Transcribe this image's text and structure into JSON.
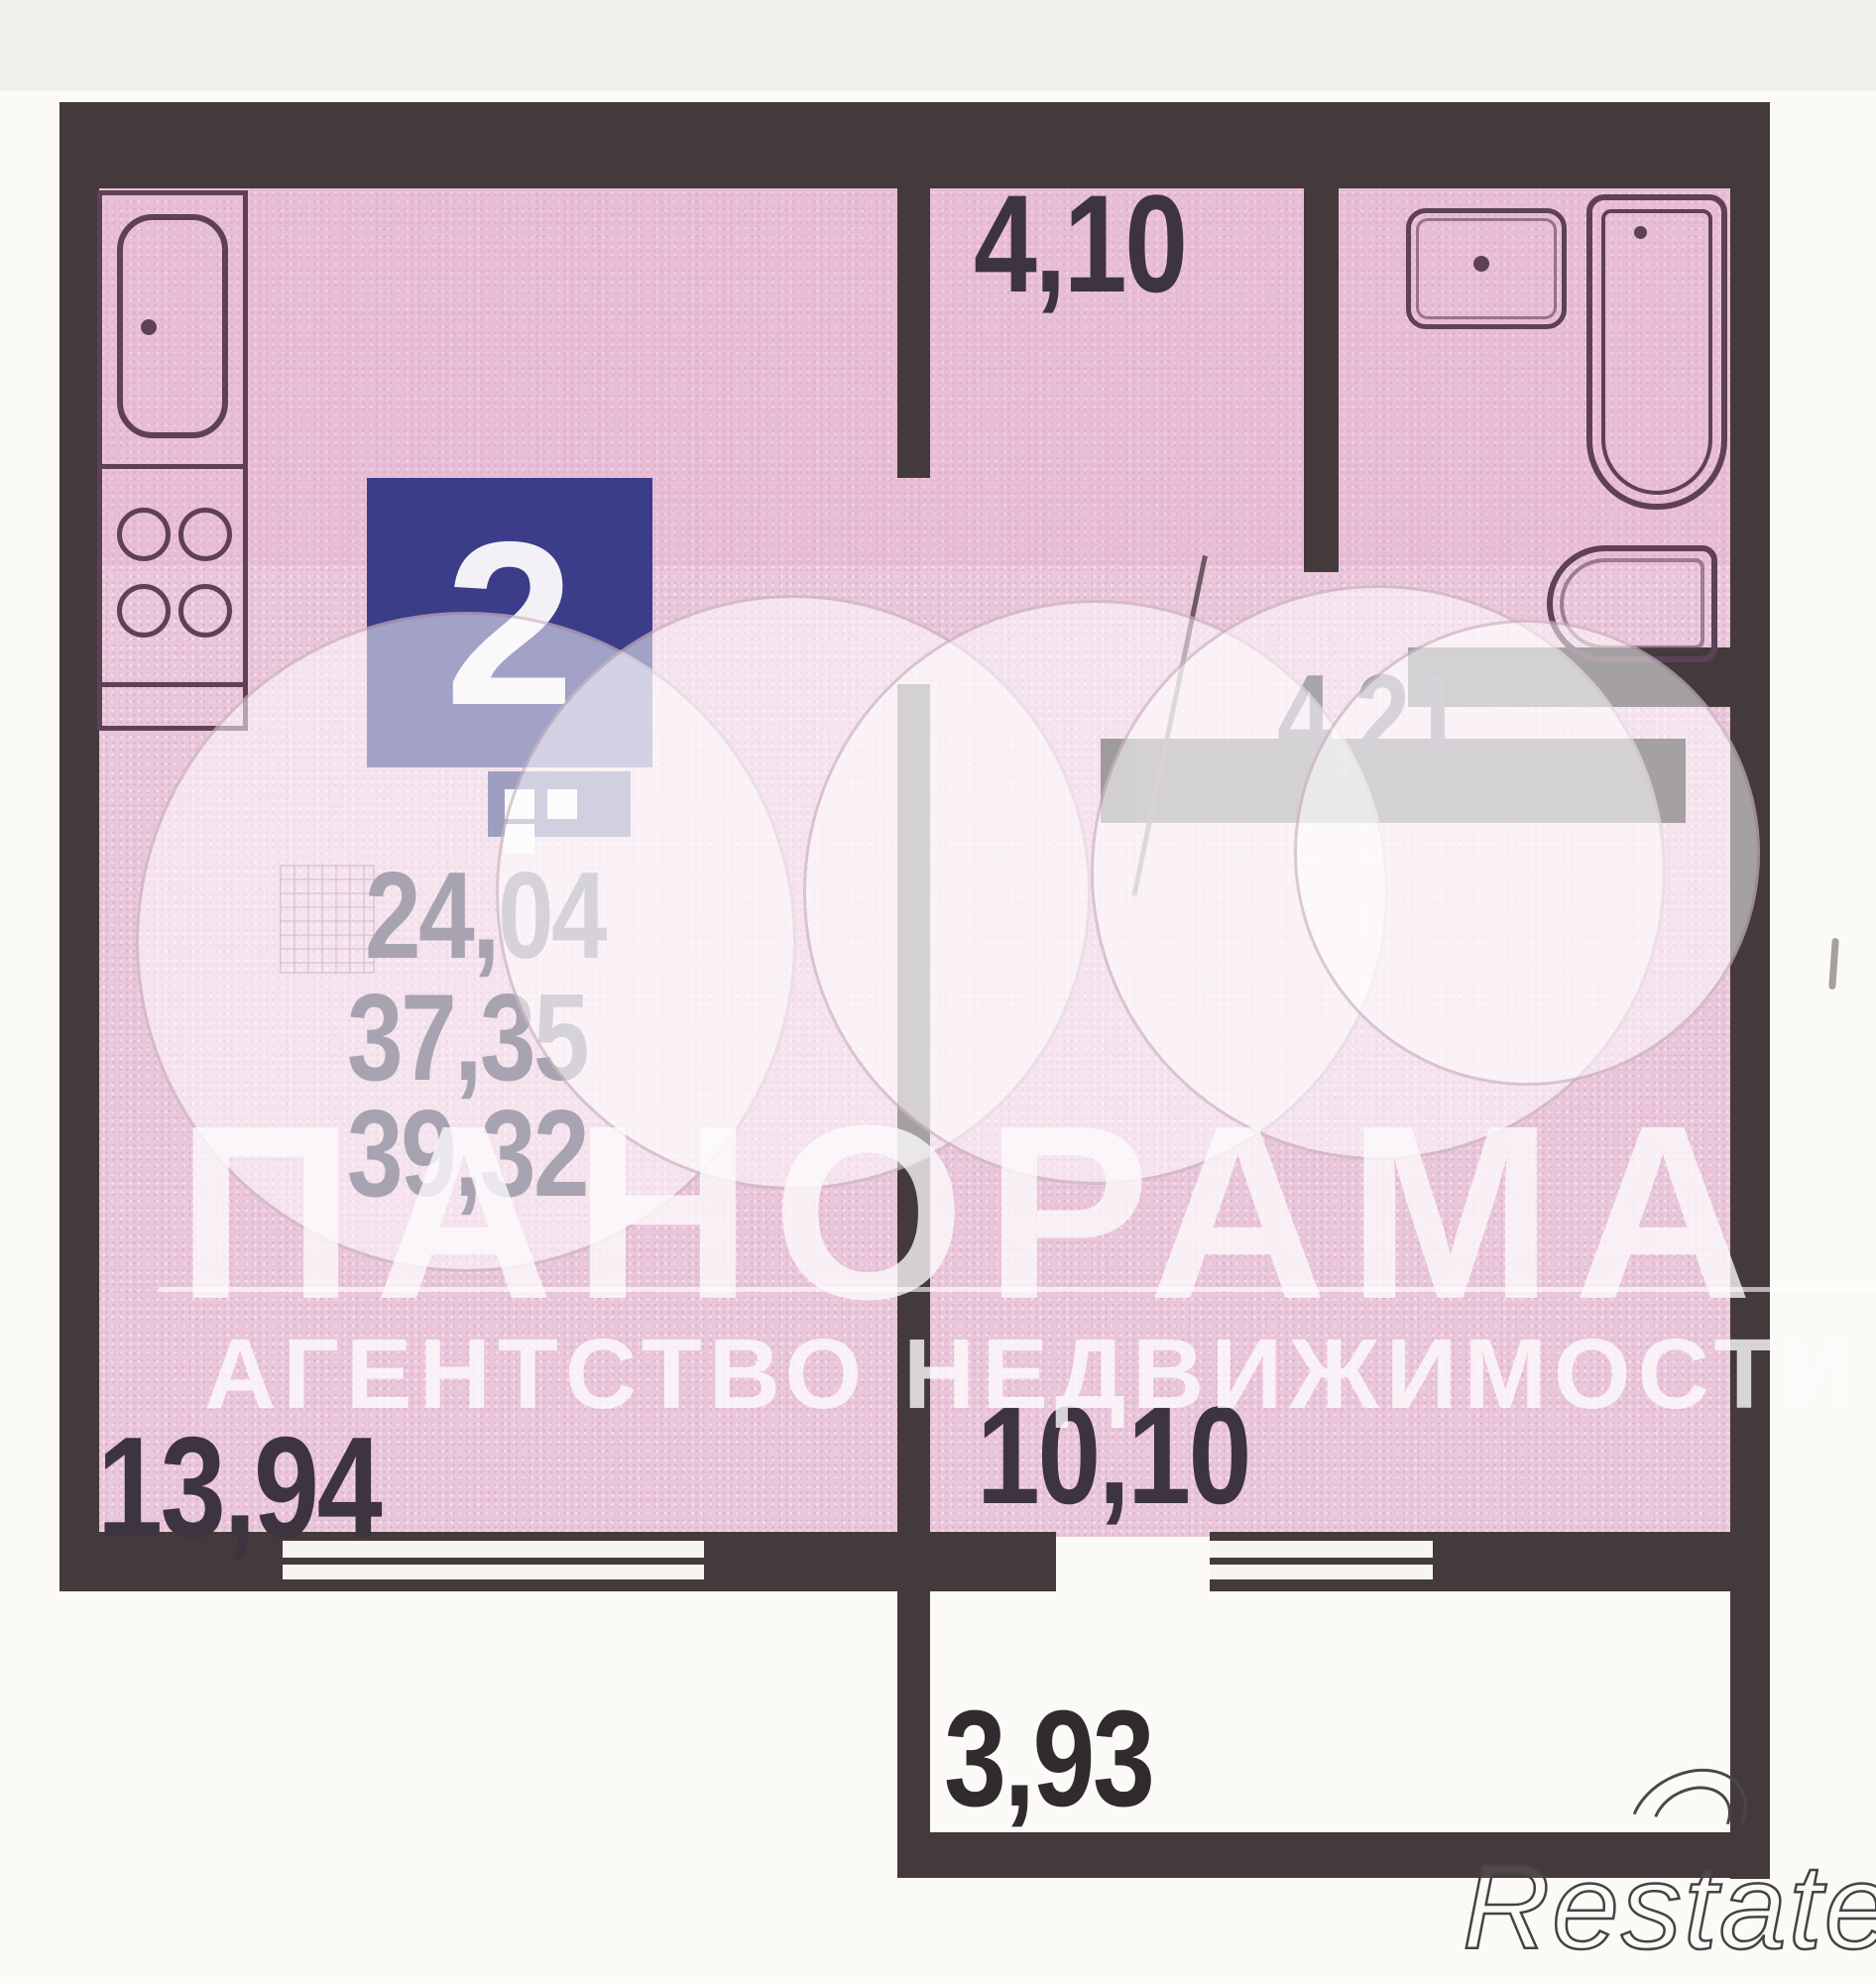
{
  "floorplan": {
    "badge": {
      "rooms": "2"
    },
    "areas": [
      "24,04",
      "37,35",
      "39,32"
    ],
    "rooms": [
      {
        "name": "hallway",
        "area": "4,10"
      },
      {
        "name": "bathroom",
        "area": "4,21"
      },
      {
        "name": "kitchen-living-room",
        "area": "13,94"
      },
      {
        "name": "room",
        "area": "10,10"
      },
      {
        "name": "balcony",
        "area": "3,93"
      }
    ]
  },
  "watermark": {
    "title": "ПАНОРАМА",
    "subtitle": "АГЕНТСТВО НЕДВИЖИМОСТИ"
  },
  "brand": {
    "name": "Restate"
  },
  "icons": {
    "kitchen-sink-icon": "rounded-rect basin with faucet dot",
    "stove-icon": "four burner circles",
    "bathroom-sink-icon": "rounded square with dot",
    "bathtub-icon": "tall rounded tub outline with drain dot",
    "toilet-icon": "d-shape bowl",
    "room-window-icon": "blue rectangle with three white panes",
    "shaft-icon": "cross-hatched square",
    "window-icon": "double-line wall opening"
  },
  "colors": {
    "floor": "#eac6da",
    "walls": "#443a3b",
    "fixtures": "#5e4156",
    "badge_blue": "#3b3d88",
    "badge_icon_blue": "#33357c",
    "labels": "#3d3440",
    "area_text": "#48405a",
    "watermark_white": "#fdfbfd",
    "page_background": "#fbfaf6"
  }
}
